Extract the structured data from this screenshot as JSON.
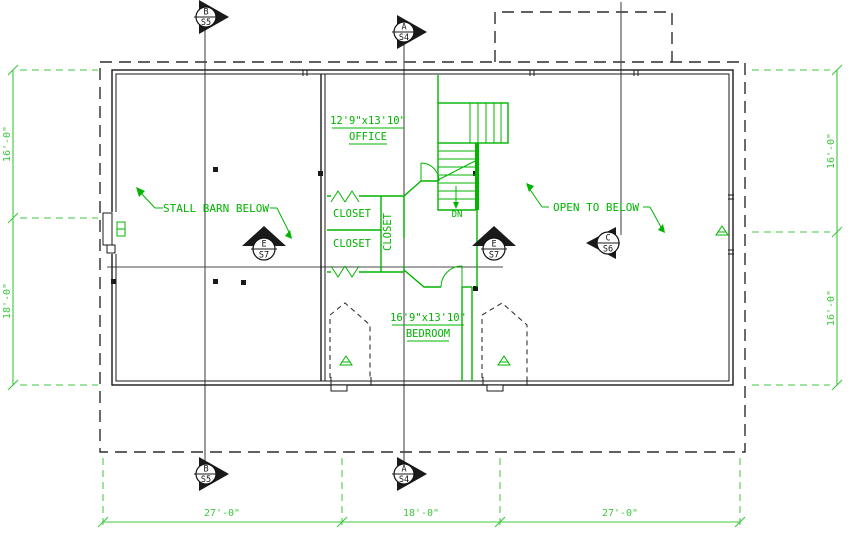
{
  "labels": {
    "office_dims": "12'9\"x13'10\"",
    "office_name": "OFFICE",
    "bedroom_dims": "16'9\"x13'10\"",
    "bedroom_name": "BEDROOM",
    "closet_upper": "CLOSET",
    "closet_lower": "CLOSET",
    "closet_vertical": "CLOSET",
    "stall_barn_note": "STALL BARN BELOW",
    "open_below_note": "OPEN TO BELOW",
    "stair_down": "DN"
  },
  "markers": {
    "b": {
      "letter": "B",
      "sheet": "S5"
    },
    "a": {
      "letter": "A",
      "sheet": "S4"
    },
    "e": {
      "letter": "E",
      "sheet": "S7"
    },
    "c": {
      "letter": "C",
      "sheet": "S6"
    }
  },
  "dimensions": {
    "bottom": [
      "27'-0\"",
      "18'-0\"",
      "27'-0\""
    ],
    "left": [
      "16'-0\"",
      "18'-0\""
    ],
    "right": [
      "16'-0\"",
      "16'-0\""
    ]
  },
  "colors": {
    "plan_green": "#00b400",
    "dim_green": "#3dc83d",
    "wall_black": "#1a1a1a",
    "section_gray": "#4a4a4a"
  }
}
